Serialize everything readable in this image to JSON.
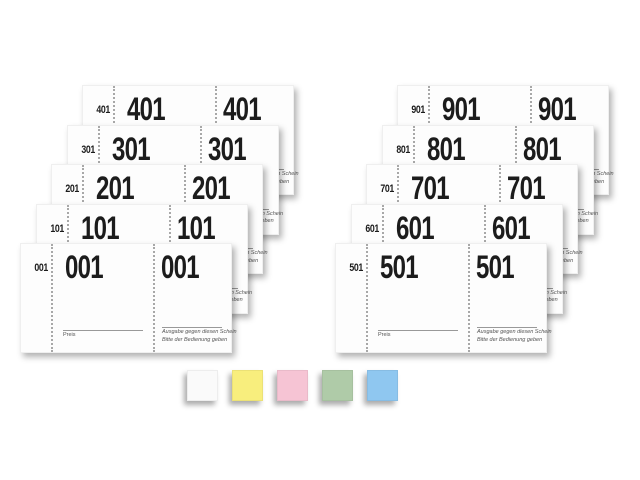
{
  "scene": {
    "background": "#ffffff",
    "description": "Two fanned stacks of sequentially numbered ticket pads with five paper colour swatches"
  },
  "stacks": [
    {
      "id": "left",
      "x": 20,
      "y": 85,
      "pads": [
        {
          "number": "001"
        },
        {
          "number": "101"
        },
        {
          "number": "201"
        },
        {
          "number": "301"
        },
        {
          "number": "401"
        }
      ]
    },
    {
      "id": "right",
      "x": 335,
      "y": 85,
      "pads": [
        {
          "number": "501"
        },
        {
          "number": "601"
        },
        {
          "number": "701"
        },
        {
          "number": "801"
        },
        {
          "number": "901"
        }
      ]
    }
  ],
  "ticket": {
    "price_label": "Preis",
    "issue_note_line1": "Ausgabe gegen diesen Schein",
    "issue_note_line2": "Bitte der Bedienung geben",
    "number_color": "#1c1c1c",
    "paper_color": "#fdfdfd"
  },
  "swatches": [
    {
      "name": "white",
      "color": "#fafafa"
    },
    {
      "name": "yellow",
      "color": "#f8ee7d"
    },
    {
      "name": "pink",
      "color": "#f6c4d4"
    },
    {
      "name": "green",
      "color": "#afcba8"
    },
    {
      "name": "blue",
      "color": "#8fc7f0"
    }
  ]
}
